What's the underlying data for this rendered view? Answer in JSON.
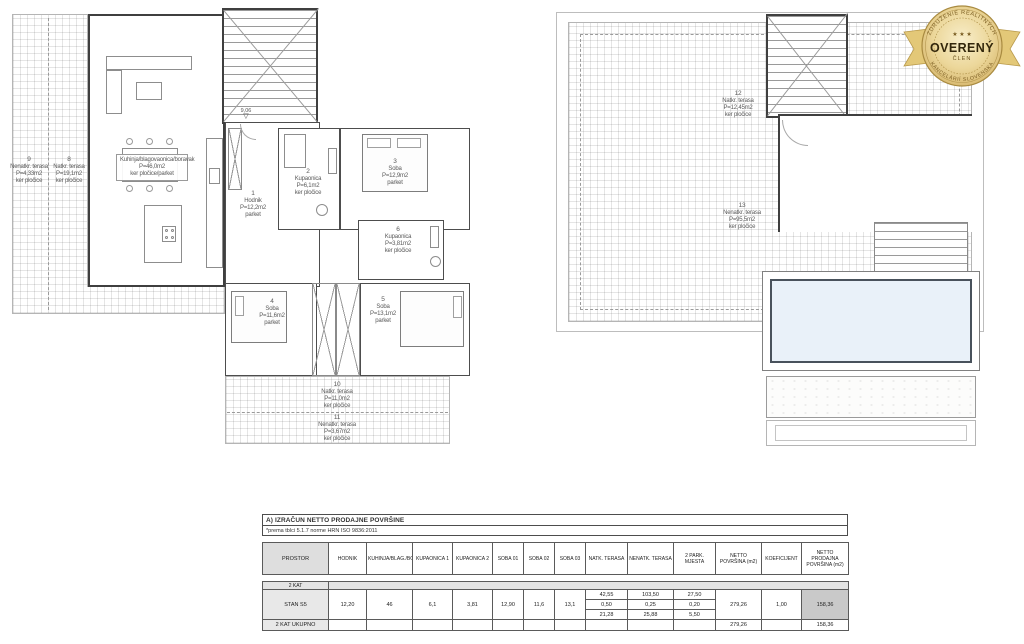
{
  "badge": {
    "arc_top": "ZDRUŽENIE REALITNÝCH",
    "arc_bottom": "KANCELÁRIÍ SLOVENSKA",
    "stars": "★ ★ ★",
    "center": "OVERENÝ",
    "sub": "ČLEN"
  },
  "colors": {
    "pool_water": "#e9f1f9",
    "badge_gold": "#dfc379",
    "table_highlight": "#c9c9c9",
    "plan_wall": "#3f3f3f"
  },
  "plans": {
    "left": {
      "level_marker": "9,06",
      "rooms": [
        {
          "num": "1",
          "name": "Hodnik",
          "area": "P=12,2m2",
          "mat": "parket"
        },
        {
          "num": "2",
          "name": "Kupaonica",
          "area": "P=6,1m2",
          "mat": "ker pločice"
        },
        {
          "num": "3",
          "name": "Soba",
          "area": "P=12,9m2",
          "mat": "parket"
        },
        {
          "num": "4",
          "name": "Soba",
          "area": "P=11,6m2",
          "mat": "parket"
        },
        {
          "num": "5",
          "name": "Soba",
          "area": "P=13,1m2",
          "mat": "parket"
        },
        {
          "num": "6",
          "name": "Kupaonica",
          "area": "P=3,81m2",
          "mat": "ker pločice"
        },
        {
          "num": "",
          "name": "Kuhinja/blagovaonica/boravak",
          "area": "P=46,0m2",
          "mat": "ker pločice/parket"
        },
        {
          "num": "8",
          "name": "Natkr. terasa",
          "area": "P=19,1m2",
          "mat": "ker pločice"
        },
        {
          "num": "9",
          "name": "Nenatkr. terasa",
          "area": "P=4,33m2",
          "mat": "ker pločice"
        },
        {
          "num": "10",
          "name": "Natkr. terasa",
          "area": "P=11,0m2",
          "mat": "ker pločice"
        },
        {
          "num": "11",
          "name": "Nenatkr. terasa",
          "area": "P=3,67m2",
          "mat": "ker pločice"
        }
      ]
    },
    "right": {
      "rooms": [
        {
          "num": "12",
          "name": "Natkr. terasa",
          "area": "P=12,45m2",
          "mat": "ker pločice"
        },
        {
          "num": "13",
          "name": "Nenatkr. terasa",
          "area": "P=95,5m2",
          "mat": "ker pločice"
        }
      ]
    }
  },
  "table": {
    "title": "A)   IZRAČUN NETTO PRODAJNE POVRŠINE",
    "subtitle": "*prema tblci 5.1.7 norme HRN ISO 9836:2011",
    "col_prostor": "PROSTOR",
    "columns": [
      "HODNIK",
      "KUHINJA/BLAG./BORAV.",
      "KUPAONICA 1",
      "KUPAONICA 2",
      "SOBA 01",
      "SOBA 02",
      "SOBA 03",
      "NATK. TERASA",
      "NENATK. TERASA",
      "2 PARK. MJESTA",
      "NETTO POVRŠINA (m2)",
      "KOEFICIJENT",
      "NETTO PRODAJNA POVRŠINA (m2)"
    ],
    "section": "2 KAT",
    "row_label": "STAN S5",
    "values": {
      "hodnik": "12,20",
      "kuhinja": "46",
      "kup1": "6,1",
      "kup2": "3,81",
      "soba1": "12,90",
      "soba2": "11,6",
      "soba3": "13,1",
      "natk": [
        "42,55",
        "0,50",
        "21,28"
      ],
      "nenatk": [
        "103,50",
        "0,25",
        "25,88"
      ],
      "park": [
        "27,50",
        "0,20",
        "5,50"
      ],
      "netto": "279,26",
      "koef": "1,00",
      "prodajna": "158,36"
    },
    "total_label": "2 KAT UKUPNO",
    "total_netto": "279,26",
    "total_prodajna": "158,36"
  }
}
